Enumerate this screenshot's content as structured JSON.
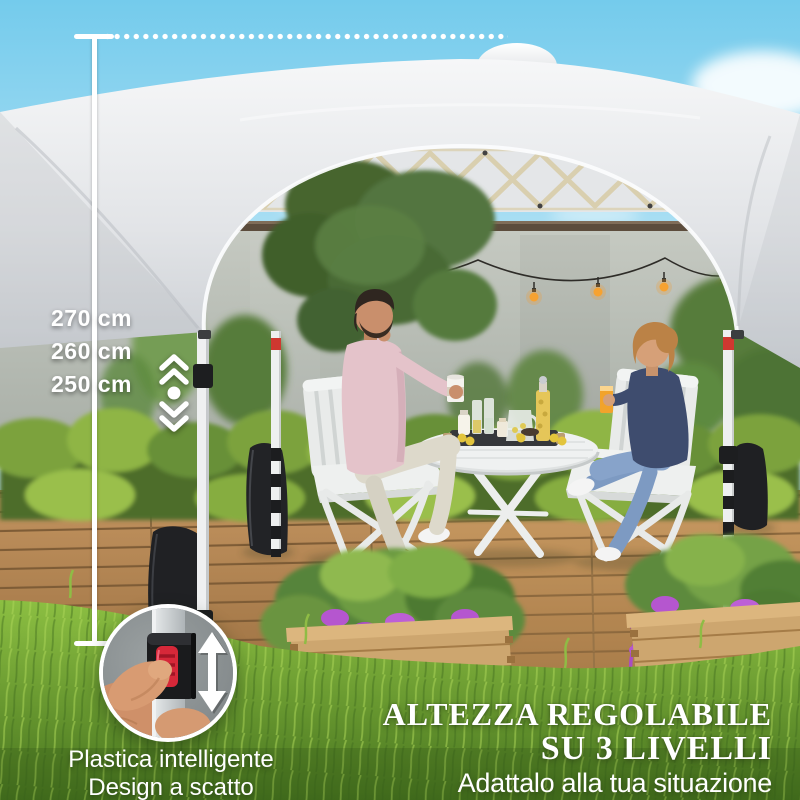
{
  "measurement": {
    "labels": [
      "270 cm",
      "260 cm",
      "250 cm"
    ]
  },
  "inset": {
    "caption_line1": "Plastica intelligente",
    "caption_line2": "Design a scatto"
  },
  "promo": {
    "title_line1": "ALTEZZA REGOLABILE",
    "title_line2": "SU 3 LIVELLI",
    "subtitle": "Adattalo alla tua situazione"
  },
  "icons": {
    "height_adjust_indicator": "double-chevron-up + dot + double-chevron-down",
    "inset_direction_arrow": "vertical double-headed arrow",
    "measure_line": "vertical rule with end caps and dotted extension"
  },
  "colors": {
    "text": "#ffffff",
    "accent_red_button": "#d62839",
    "leg_red_band": "#cf3830",
    "canopy_white": "#e9ebed",
    "sky_blue": "#74cbec",
    "wall_grey": "#bcc0b9",
    "hedge_green": "#7ca23c",
    "grass_green": "#6fa430",
    "deck_wood": "#b3854f",
    "planter_wood": "#cda66f",
    "flower_purple": "#b556cf",
    "weight_bag_black": "#1f2023",
    "bulb_orange": "#f59b2e"
  }
}
